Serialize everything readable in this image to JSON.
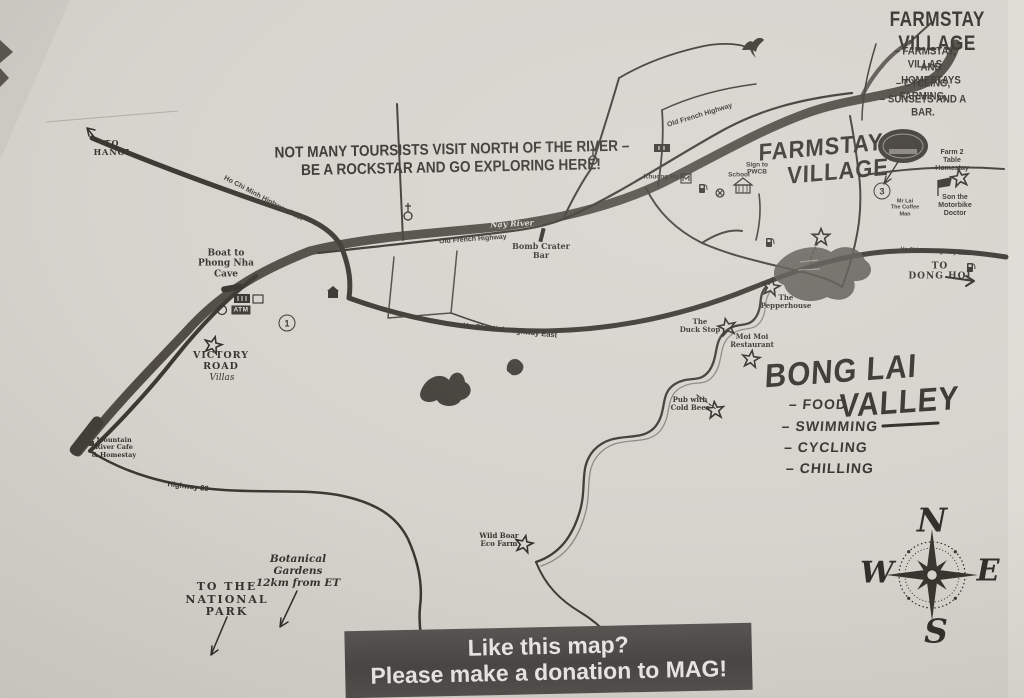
{
  "colors": {
    "paper": "#d6d2cc",
    "ink": "#34302b",
    "river": "#454139",
    "banner_bg": "#4b4947",
    "banner_text": "#ecebe8"
  },
  "farmstay_legend": {
    "title": "FARMSTAY VILLAGE",
    "item1": "– FARMSTAY, VILLAS",
    "item1b": "AND HOMESTAYS",
    "item2": "– CYCLING, FARMING,",
    "item3": "– SUNSETS AND A BAR."
  },
  "note": {
    "line1": "NOT MANY TOURSISTS VISIT NORTH OF THE RIVER –",
    "line2": "BE A ROCKSTAR AND GO EXPLORING HERE!"
  },
  "handwritten": {
    "farmstay_line1": "FARMSTAY",
    "farmstay_line2": "VILLAGE",
    "bonglai_line1": "BONG LAI",
    "bonglai_line2": "VALLEY",
    "bonglai_item1": "– FOOD",
    "bonglai_item2": "– SWIMMING",
    "bonglai_item3": "– CYCLING",
    "bonglai_item4": "– CHILLING"
  },
  "directions": {
    "to_hanoi": "TO\nHANOI",
    "to_dong_hoi": "TO\nDONG HOI",
    "to_national_park": "TO THE\nNATIONAL\nPARK",
    "botanical_gardens": "Botanical\nGardens\n12km from ET"
  },
  "roads": {
    "hcm_east": "Ho Chi Minh Highway East",
    "old_french": "Old French Highway",
    "highway_20": "Highway 20",
    "river_name": "Nậy River"
  },
  "pois": {
    "boat_phong_nha": "Boat to\nPhong Nha\nCave",
    "atm": "ATM",
    "victory_road_1": "VICTORY\nROAD",
    "victory_road_2": "Villas",
    "bomb_crater": "Bomb Crater\nBar",
    "khuong_ha": "Khuong Ha",
    "sign_pwcb": "Sign to\nPWCB",
    "school": "School",
    "farm_2_table": "Farm 2\nTable\nHomestay",
    "son_motorbike": "Son the\nMotorbike\nDoctor",
    "coffee_man": "Mr Lai\nThe Coffee\nMan",
    "pepperhouse": "The\nPepperhouse",
    "duck_stop": "The\nDuck Stop",
    "moi_moi": "Moi Moi\nRestaurant",
    "pub_cold_beer": "Pub with\nCold Beer",
    "wild_boar": "Wild Boar\nEco Farm",
    "mountain_river": "Mountain\nRiver Cafe\n& Homestay"
  },
  "markers": {
    "route_1": "1",
    "route_3": "3"
  },
  "compass": {
    "n": "N",
    "e": "E",
    "s": "S",
    "w": "W"
  },
  "banner": {
    "line1": "Like this map?",
    "line2": "Please make a donation to MAG!"
  },
  "icons": {
    "poi_star": "hand-drawn star",
    "church": "cross on circle",
    "fuel_pump": "fuel pump",
    "school_building": "house with pillars",
    "boat_dock": "boat at dock",
    "bird": "bird silhouette",
    "flag": "flag marker",
    "farmstay_logo": "oval badge logo",
    "compass_rose": "8-point compass rose"
  }
}
